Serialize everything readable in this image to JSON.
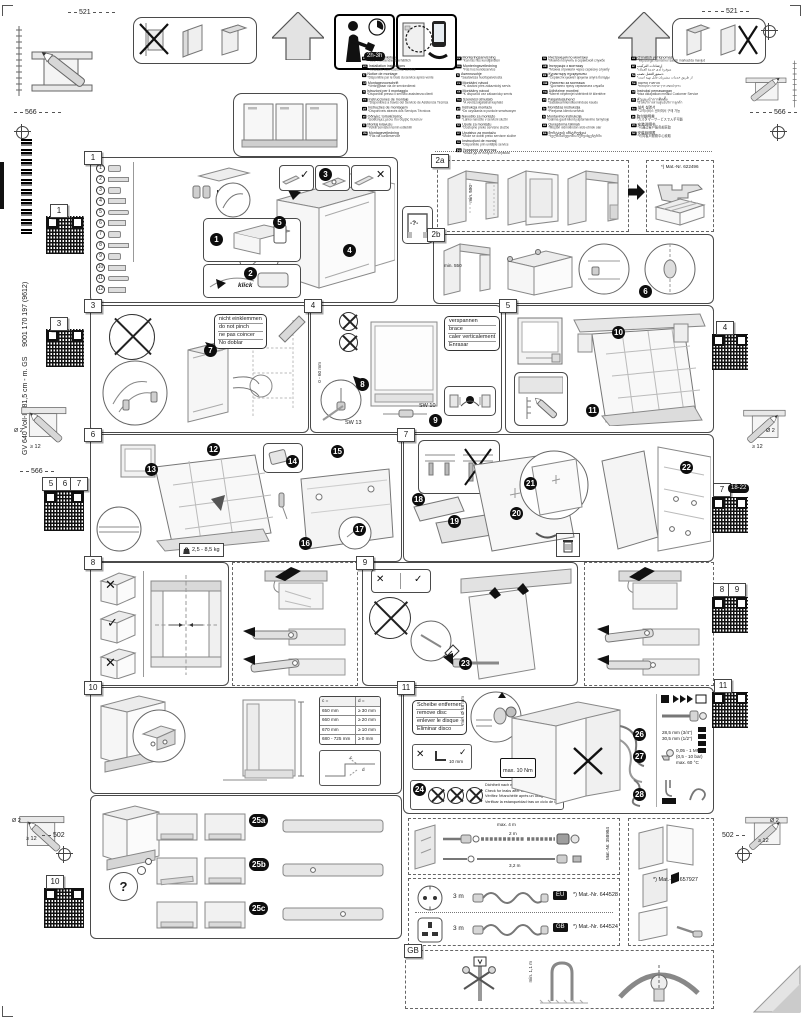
{
  "doc": {
    "dim_521": "521",
    "dim_566": "566",
    "dim_502": "502",
    "drill_dia": "Ø 2",
    "drill_depth": "≥ 12",
    "time_estimate": "2h-3h",
    "product_line": "GV 640 Voll-I - 81,5 cm - m. GS",
    "doc_number": "9001 170 197 (9612)"
  },
  "languages": {
    "col1": [
      {
        "code": "de",
        "title": "Montageanleitung",
        "note": "*über Kundendienst erhältlich"
      },
      {
        "code": "en",
        "title": "Installation instructions",
        "note": "*Available from customer service"
      },
      {
        "code": "fr",
        "title": "Notice de montage",
        "note": "*Disponible par le biais du service après-vente"
      },
      {
        "code": "nl",
        "title": "Montagevoorschrift",
        "note": "*Verkrijgbaar via de servicedienst"
      },
      {
        "code": "it",
        "title": "Istruzioni per il montaggio",
        "note": "*Disponibili presso il servizio assistenza clienti"
      },
      {
        "code": "es",
        "title": "Instrucciones de montaje",
        "note": "*Disponibles a través del Servicio de Asistencia Técnica"
      },
      {
        "code": "pt",
        "title": "Instruções de montagem",
        "note": "*Disponíveis através dos Serviços Técnicos"
      },
      {
        "code": "el",
        "title": "Οδηγίες τοποθέτησης",
        "note": "*Διαθέσιμες μέσω του σέρβις πελατών"
      },
      {
        "code": "tr",
        "title": "Montaj kılavuzu",
        "note": "*Yetkili servisten temin edilebilir"
      },
      {
        "code": "da",
        "title": "Montagevejledning",
        "note": "*Fås via kundeservice"
      }
    ],
    "col2": [
      {
        "code": "sv",
        "title": "Monteringsanvisning",
        "note": "*Kan fås hos kundtjänsten"
      },
      {
        "code": "no",
        "title": "Monteringsveiledning",
        "note": "*Fås hos kundeservice"
      },
      {
        "code": "fi",
        "title": "Asennusohje",
        "note": "*Saatavissa huoltopalvelusta"
      },
      {
        "code": "cs",
        "title": "Montážní návod",
        "note": "*K dostání přes zákaznický servis"
      },
      {
        "code": "sk",
        "title": "Montážny návod",
        "note": "*K dispozícii cez zákaznícky servis"
      },
      {
        "code": "hu",
        "title": "Szerelési útmutató",
        "note": "*A vevőszolgálatnál kapható"
      },
      {
        "code": "pl",
        "title": "Instrukcja montażu",
        "note": "*Do uzyskania w punkcie serwisowym"
      },
      {
        "code": "sl",
        "title": "Navodilo za montažo",
        "note": "*Lahko naročite v servisni službi"
      },
      {
        "code": "hr",
        "title": "Upute za montažu",
        "note": "*Dostupne preko servisne službe"
      },
      {
        "code": "sr",
        "title": "Uputstvo za montažu",
        "note": "*Može se dobiti preko servisne službe"
      },
      {
        "code": "ro",
        "title": "Instrucţiuni de montaj",
        "note": "*Disponibile prin unităţile service"
      },
      {
        "code": "bg",
        "title": "Указание за монтаж",
        "note": "*Може да се получи от сервиза"
      }
    ],
    "col3": [
      {
        "code": "ru",
        "title": "Инструкция по монтажу",
        "note": "*Можно получить в сервисной службе"
      },
      {
        "code": "uk",
        "title": "Інструкція з монтажу",
        "note": "*Можна отримати через сервісну службу"
      },
      {
        "code": "kk",
        "title": "Құрастыру нұсқаулығы",
        "note": "*Сервистік қызмет арқылы алуға болады"
      },
      {
        "code": "mk",
        "title": "Упатство за монтажа",
        "note": "*Достапно преку сервисната служба"
      },
      {
        "code": "sq",
        "title": "Udhëzime montimi",
        "note": "*Merret nëpërmjet shërbimit të klientëve"
      },
      {
        "code": "et",
        "title": "Paigaldusjuhend",
        "note": "*Saadaval klienditeeninduse kaudu"
      },
      {
        "code": "lv",
        "title": "Montāžas instrukcija",
        "note": "*Pieejama klientu servisā"
      },
      {
        "code": "lt",
        "title": "Montavimo instrukcija",
        "note": "*Galima gauti klientų aptarnavimo tarnyboje"
      },
      {
        "code": "az",
        "title": "Quraşdırma təlimatı",
        "note": "*Müştəri xidmətindən əldə etmək olar"
      },
      {
        "code": "ka",
        "title": "მონტაჟის ინსტრუქცია",
        "note": "*ხელმისაწვდომია სერვისცენტრში"
      }
    ],
    "col4": [
      {
        "code": "uz",
        "title": "O‘rnatish yo‘riqnomasi",
        "note": "*Mijozlarga xizmat ko‘rsatish markazida mavjud"
      },
      {
        "code": "ar",
        "title": "إرشادات التركيب",
        "note": "*متوفرة لدى خدمة العملاء"
      },
      {
        "code": "fa",
        "title": "دستورالعمل نصب",
        "note": "*از طریق خدمات مشتریان قابل تهیه است"
      },
      {
        "code": "he",
        "title": "הוראות התקנה",
        "note": "*ניתן להשיג דרך שירות הלקוחות"
      },
      {
        "code": "id",
        "title": "Instruksi pemasangan",
        "note": "*bisa didapatkan melalui Customer Service"
      },
      {
        "code": "th",
        "title": "คำแนะนำการติดตั้ง",
        "note": "*มีให้บริการผ่านศูนย์บริการลูกค้า"
      },
      {
        "code": "ko",
        "title": "설치 설명서",
        "note": "*고객서비스 센터에서 구매 가능"
      },
      {
        "code": "ja",
        "title": "取付説明書",
        "note": "*カスタマーサービスで入手可能"
      },
      {
        "code": "zh",
        "title": "安装说明书",
        "note": "*可通过客户服务部获取"
      },
      {
        "code": "tw",
        "title": "安裝說明書",
        "note": "*可向客戶服務中心索取"
      }
    ]
  },
  "panels": {
    "q_box": "-?-",
    "p1": {
      "num": "1",
      "klick": "klick",
      "steps": {
        "s1": "1",
        "s2": "2",
        "s3": "3",
        "s4": "4",
        "s5": "5"
      },
      "parts": [
        "1",
        "2",
        "3",
        "4",
        "5",
        "6",
        "7",
        "8",
        "9",
        "10",
        "11",
        "12"
      ]
    },
    "p2a": {
      "num": "2a",
      "dim": "min. 550",
      "mat_nr": "*) Mat.-Nr. 622496"
    },
    "p2b": {
      "num": "2b",
      "dim": "min. 550",
      "step": "6"
    },
    "p3": {
      "num": "3",
      "step": "7",
      "note": [
        "nicht einklemmen",
        "do not pinch",
        "ne pas coincer",
        "No doblar"
      ]
    },
    "p4": {
      "num": "4",
      "s8": "8",
      "s9": "9",
      "sw13": "SW 13",
      "sw10": "SW 10",
      "range": "0 - 60 mm",
      "note": [
        "verspannen",
        "brace",
        "caler verticalement",
        "Enrasar"
      ]
    },
    "p5": {
      "num": "5",
      "s10": "10",
      "s11": "11"
    },
    "p6": {
      "num": "6",
      "s12": "12",
      "s13": "13",
      "s14": "14",
      "s15": "15",
      "s16": "16",
      "s17": "17",
      "weight": "2,5 - 8,5 kg"
    },
    "p7": {
      "num": "7",
      "s18": "18",
      "s19": "19",
      "s20": "20",
      "s21": "21",
      "s22": "22"
    },
    "p8": {
      "num": "8"
    },
    "p9": {
      "num": "9",
      "s23": "23"
    },
    "p10": {
      "num": "10",
      "question": "?",
      "s25a": "25a",
      "s25b": "25b",
      "s25c": "25c",
      "label_c": "c",
      "label_d": "d",
      "table": {
        "h1": "c =",
        "h2": "d =",
        "rows": [
          {
            "c": "650 mm",
            "d": "≥ 30 mm"
          },
          {
            "c": "660 mm",
            "d": "≥ 20 mm"
          },
          {
            "c": "670 mm",
            "d": "≥ 10 mm"
          },
          {
            "c": "680 - 725 mm",
            "d": "≥ 0 mm"
          }
        ]
      }
    },
    "p11": {
      "num": "11",
      "s24": "24",
      "s26": "26",
      "s27": "27",
      "s28": "28",
      "note": [
        "Scheibe entfernen",
        "remove disc",
        "enlever le disque",
        "Eliminar disco"
      ],
      "torque": "max. 10 Nm",
      "allen": "10 mm",
      "min_dia": "min. Ø 18 mm",
      "leak": [
        "Dichtheit nach einem Spülgang prüfen.",
        "Check for leaks after one wash cycle.",
        "Vérifiez l'étanchéité après un usage.",
        "Verificar la estanqueidad tras un ciclo de lavado."
      ],
      "conn_a": "28,5 mm (3/4\")",
      "conn_b": "30,5 mm (1/2\")",
      "pressure": "0,05 - 1 MPa",
      "pressure_bar": "(0,5 - 10 bar)",
      "temp": "max. 60 °C"
    }
  },
  "bottom": {
    "hose": {
      "max": "max. 4 m",
      "mid": "2 m",
      "low": "3,2 m",
      "mat": "Mat.-Nr. 358984"
    },
    "cords": [
      {
        "len": "3 m",
        "region": "EU",
        "mat": "*) Mat.-Nr. 644528"
      },
      {
        "len": "3 m",
        "region": "GB",
        "mat": "*) Mat.-Nr. 644524"
      }
    ],
    "panel_mat": "*) Mat.-Nr. 657927",
    "gb_label": "GB",
    "gb_height": "min. 1,1 m"
  },
  "qr_labels": {
    "q1": "1",
    "q3": "3",
    "q4": "4",
    "q5": "5",
    "q6": "6",
    "q7s": "7",
    "q7": "7",
    "q7_range": "18-22",
    "q8": "8",
    "q9": "9",
    "q10": "10",
    "q11": "11"
  }
}
